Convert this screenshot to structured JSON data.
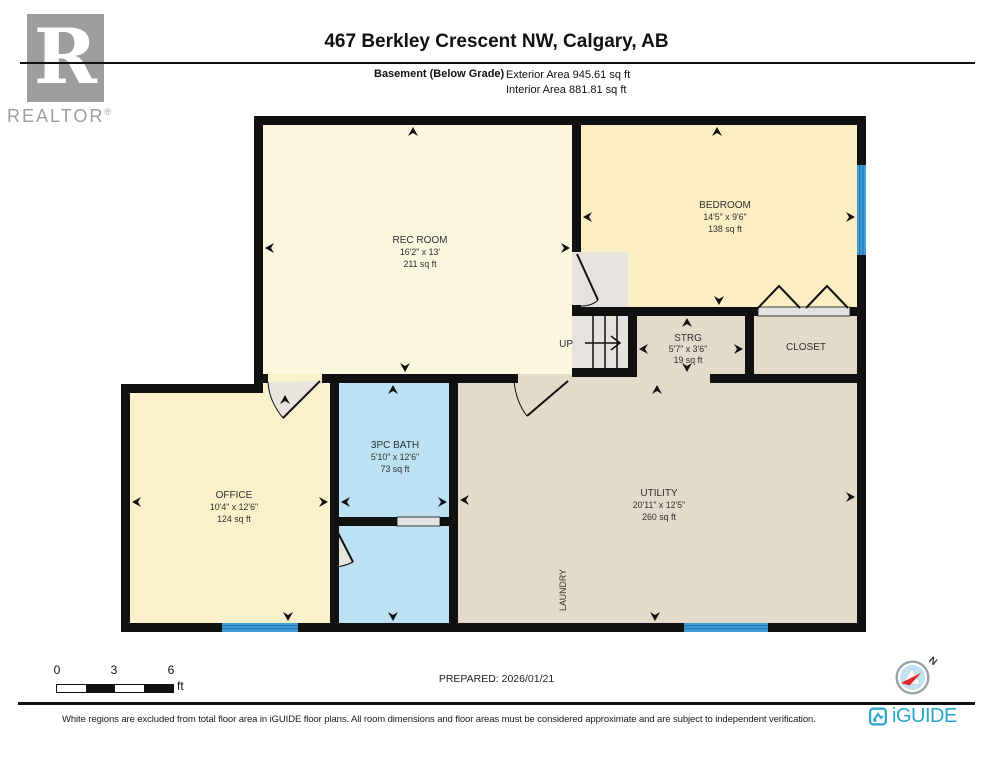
{
  "header": {
    "realtor_r": "R",
    "realtor_text": "REALTOR",
    "realtor_reg": "®",
    "title": "467 Berkley Crescent NW, Calgary, AB",
    "floor_label": "Basement (Below Grade)",
    "exterior_area": "Exterior Area 945.61 sq ft",
    "interior_area": "Interior Area 881.81 sq ft"
  },
  "plan": {
    "rooms": {
      "rec": {
        "name": "REC ROOM",
        "dims": "16'2\" x 13'",
        "area": "211 sq ft"
      },
      "bedroom": {
        "name": "BEDROOM",
        "dims": "14'5\" x 9'6\"",
        "area": "138 sq ft"
      },
      "strg": {
        "name": "STRG",
        "dims": "5'7\" x 3'6\"",
        "area": "19 sq ft"
      },
      "closet": {
        "name": "CLOSET"
      },
      "bath": {
        "name": "3PC BATH",
        "dims": "5'10\" x 12'6\"",
        "area": "73 sq ft"
      },
      "office": {
        "name": "OFFICE",
        "dims": "10'4\" x 12'6\"",
        "area": "124 sq ft"
      },
      "utility": {
        "name": "UTILITY",
        "dims": "20'11\" x 12'5\"",
        "area": "260 sq ft"
      },
      "laundry": {
        "name": "LAUNDRY"
      }
    },
    "stairs_label": "UP"
  },
  "scale_bar": {
    "ticks": [
      "0",
      "3",
      "6"
    ],
    "unit": "ft"
  },
  "prepared": "PREPARED: 2026/01/21",
  "compass": {
    "north_label": "N"
  },
  "footer": {
    "disclaimer": "White regions are excluded from total floor area in iGUIDE floor plans. All room dimensions and floor areas must be considered approximate and are subject to independent verification.",
    "brand": "iGUIDE"
  },
  "colors": {
    "room_yellow_light": "#FBF6DE",
    "room_yellow": "#FAEEC2",
    "room_tan": "#E3DACA",
    "room_blue": "#BCE1F3",
    "stairs_gray": "#E6E3DF",
    "window_blue": "#3E9FD8",
    "wall": "#111111",
    "iguide_teal": "#2AA6CB",
    "compass_red": "#E02B2B"
  }
}
